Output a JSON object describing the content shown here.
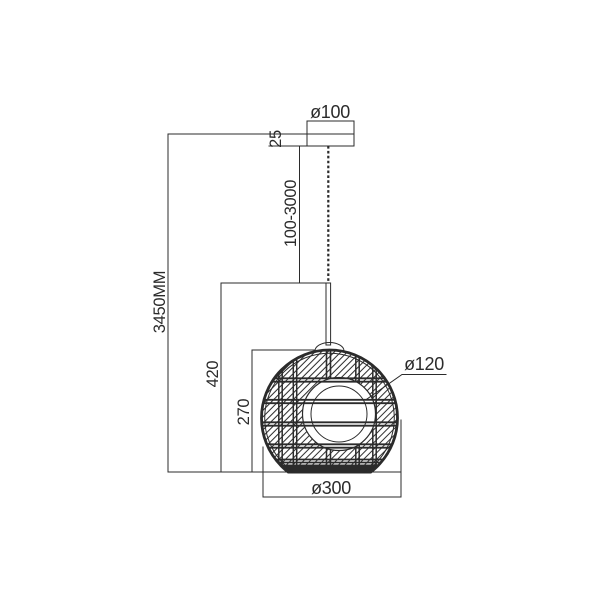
{
  "drawing": {
    "title": "pendant-lamp-dimension-drawing",
    "colors": {
      "background": "#ffffff",
      "line": "#2b2b2b"
    },
    "dimensions": {
      "canopy_diameter": {
        "label": "ø100"
      },
      "canopy_height": {
        "label": "25"
      },
      "suspension_range": {
        "label": "100-3000"
      },
      "total_height": {
        "label": "3450MM"
      },
      "drop_to_shade": {
        "label": "420"
      },
      "shade_height": {
        "label": "270"
      },
      "opening_diameter": {
        "label": "ø120"
      },
      "shade_diameter": {
        "label": "ø300"
      }
    }
  }
}
